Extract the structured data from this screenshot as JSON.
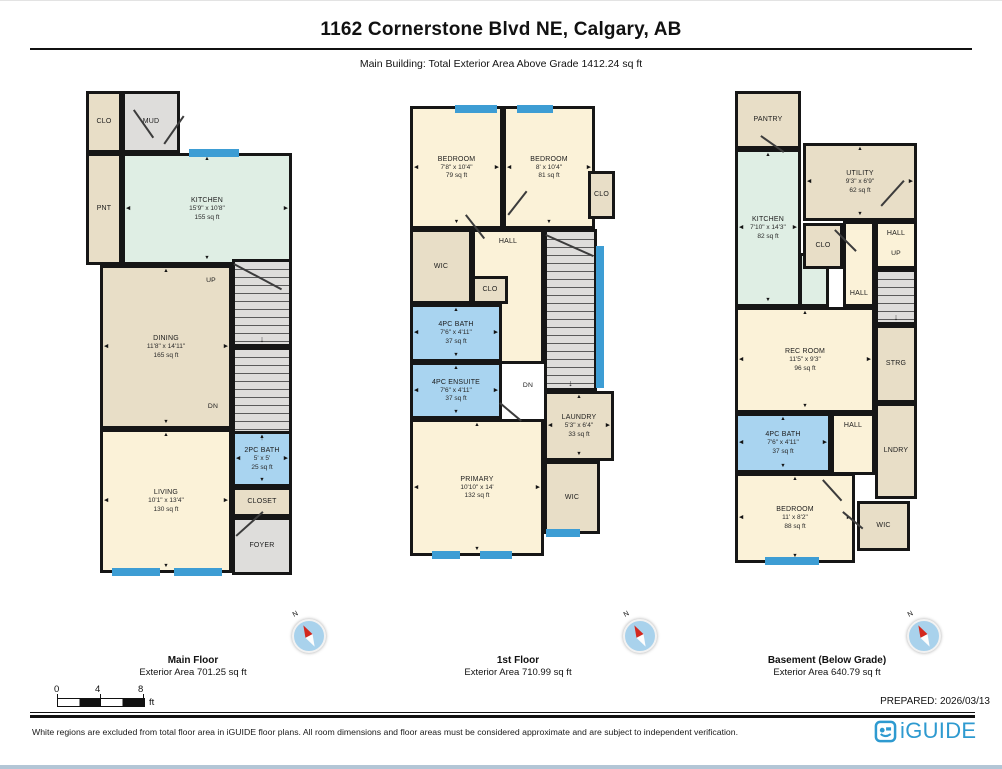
{
  "page": {
    "title": "1162 Cornerstone Blvd NE, Calgary, AB",
    "subtitle": "Main Building: Total Exterior Area Above Grade 1412.24 sq ft",
    "prepared_label": "PREPARED: 2026/03/13",
    "disclaimer": "White regions are excluded from total floor area in iGUIDE floor plans. All room dimensions and floor areas must be considered approximate and are subject to independent verification.",
    "brand": "iGUIDE"
  },
  "compass_label": "N",
  "scale_bar": {
    "ticks": [
      "0",
      "4",
      "8"
    ],
    "unit": "ft"
  },
  "colors": {
    "wall": "#161616",
    "window": "#3D9DD4",
    "cream": "#FBF2D8",
    "tan": "#E8DEC7",
    "gray": "#DEDDDB",
    "mint": "#DFEEE4",
    "blue": "#A9D4F0",
    "compass_face": "#A9D2EC",
    "compass_needle": "#D3281E",
    "brand_blue": "#2E9AD0"
  },
  "floors": [
    {
      "name": "Main Floor",
      "area_label": "Exterior Area 701.25 sq ft",
      "rooms": [
        {
          "id": "clo",
          "label": "CLO",
          "fill": "tan"
        },
        {
          "id": "mud",
          "label": "MUD",
          "fill": "gray"
        },
        {
          "id": "pnt",
          "label": "PNT",
          "fill": "tan"
        },
        {
          "id": "kitchen",
          "label": "KITCHEN",
          "dims": "15'9\" x 10'8\"",
          "area": "155 sq ft",
          "fill": "mint"
        },
        {
          "id": "dining",
          "label": "DINING",
          "dims": "11'8\" x 14'11\"",
          "area": "165 sq ft",
          "fill": "tan"
        },
        {
          "id": "stairs-up",
          "label": "",
          "fill": "gray",
          "stairs": true
        },
        {
          "id": "stairs-dn",
          "label": "",
          "fill": "gray",
          "stairs": true
        },
        {
          "id": "up-label",
          "label": "UP",
          "fill": "none"
        },
        {
          "id": "dn-label",
          "label": "DN",
          "fill": "none"
        },
        {
          "id": "living",
          "label": "LIVING",
          "dims": "10'1\" x 13'4\"",
          "area": "130 sq ft",
          "fill": "cream"
        },
        {
          "id": "bath-2pc",
          "label": "2PC BATH",
          "dims": "5' x 5'",
          "area": "25 sq ft",
          "fill": "blue"
        },
        {
          "id": "closet",
          "label": "CLOSET",
          "fill": "tan"
        },
        {
          "id": "foyer",
          "label": "FOYER",
          "fill": "gray"
        }
      ]
    },
    {
      "name": "1st Floor",
      "area_label": "Exterior Area 710.99 sq ft",
      "rooms": [
        {
          "id": "bedroom-1",
          "label": "BEDROOM",
          "dims": "7'8\" x 10'4\"",
          "area": "79 sq ft",
          "fill": "cream"
        },
        {
          "id": "bedroom-2",
          "label": "BEDROOM",
          "dims": "8' x 10'4\"",
          "area": "81 sq ft",
          "fill": "cream"
        },
        {
          "id": "clo-right",
          "label": "CLO",
          "fill": "tan"
        },
        {
          "id": "wic-upper",
          "label": "WIC",
          "fill": "tan"
        },
        {
          "id": "hall",
          "label": "HALL",
          "fill": "cream",
          "label_pos": "top"
        },
        {
          "id": "clo-small",
          "label": "CLO",
          "fill": "tan"
        },
        {
          "id": "bath-4pc",
          "label": "4PC BATH",
          "dims": "7'6\" x 4'11\"",
          "area": "37 sq ft",
          "fill": "blue"
        },
        {
          "id": "ensuite",
          "label": "4PC ENSUITE",
          "dims": "7'6\" x 4'11\"",
          "area": "37 sq ft",
          "fill": "blue"
        },
        {
          "id": "stairs",
          "label": "",
          "fill": "gray",
          "stairs": true
        },
        {
          "id": "dn-label",
          "label": "DN",
          "fill": "none"
        },
        {
          "id": "laundry",
          "label": "LAUNDRY",
          "dims": "5'3\" x 6'4\"",
          "area": "33 sq ft",
          "fill": "tan"
        },
        {
          "id": "primary",
          "label": "PRIMARY",
          "dims": "10'10\" x 14'",
          "area": "132 sq ft",
          "fill": "cream"
        },
        {
          "id": "wic-lower",
          "label": "WIC",
          "fill": "tan"
        }
      ]
    },
    {
      "name": "Basement (Below Grade)",
      "area_label": "Exterior Area 640.79 sq ft",
      "rooms": [
        {
          "id": "pantry",
          "label": "PANTRY",
          "fill": "tan"
        },
        {
          "id": "kitchen",
          "label": "KITCHEN",
          "dims": "7'10\" x 14'3\"",
          "area": "82 sq ft",
          "fill": "mint"
        },
        {
          "id": "kitchen-ext",
          "label": "",
          "fill": "mint"
        },
        {
          "id": "utility",
          "label": "UTILITY",
          "dims": "9'3\" x 6'9\"",
          "area": "62 sq ft",
          "fill": "tan"
        },
        {
          "id": "clo",
          "label": "CLO",
          "fill": "tan"
        },
        {
          "id": "hall-center",
          "label": "HALL",
          "fill": "cream",
          "label_pos": "bottom"
        },
        {
          "id": "hall-upper",
          "label": "HALL",
          "fill": "cream",
          "label_pos": "top"
        },
        {
          "id": "up-label",
          "label": "UP",
          "fill": "none"
        },
        {
          "id": "stairs",
          "label": "",
          "fill": "gray",
          "stairs": true
        },
        {
          "id": "rec-room",
          "label": "REC ROOM",
          "dims": "11'5\" x 9'3\"",
          "area": "96 sq ft",
          "fill": "cream"
        },
        {
          "id": "strg",
          "label": "STRG",
          "fill": "tan"
        },
        {
          "id": "hall-lower",
          "label": "HALL",
          "fill": "cream",
          "label_pos": "top"
        },
        {
          "id": "bath-4pc",
          "label": "4PC BATH",
          "dims": "7'6\" x 4'11\"",
          "area": "37 sq ft",
          "fill": "blue"
        },
        {
          "id": "lndry",
          "label": "LNDRY",
          "fill": "tan"
        },
        {
          "id": "bedroom",
          "label": "BEDROOM",
          "dims": "11' x 8'2\"",
          "area": "88 sq ft",
          "fill": "cream"
        },
        {
          "id": "wic",
          "label": "WIC",
          "fill": "tan"
        }
      ]
    }
  ]
}
